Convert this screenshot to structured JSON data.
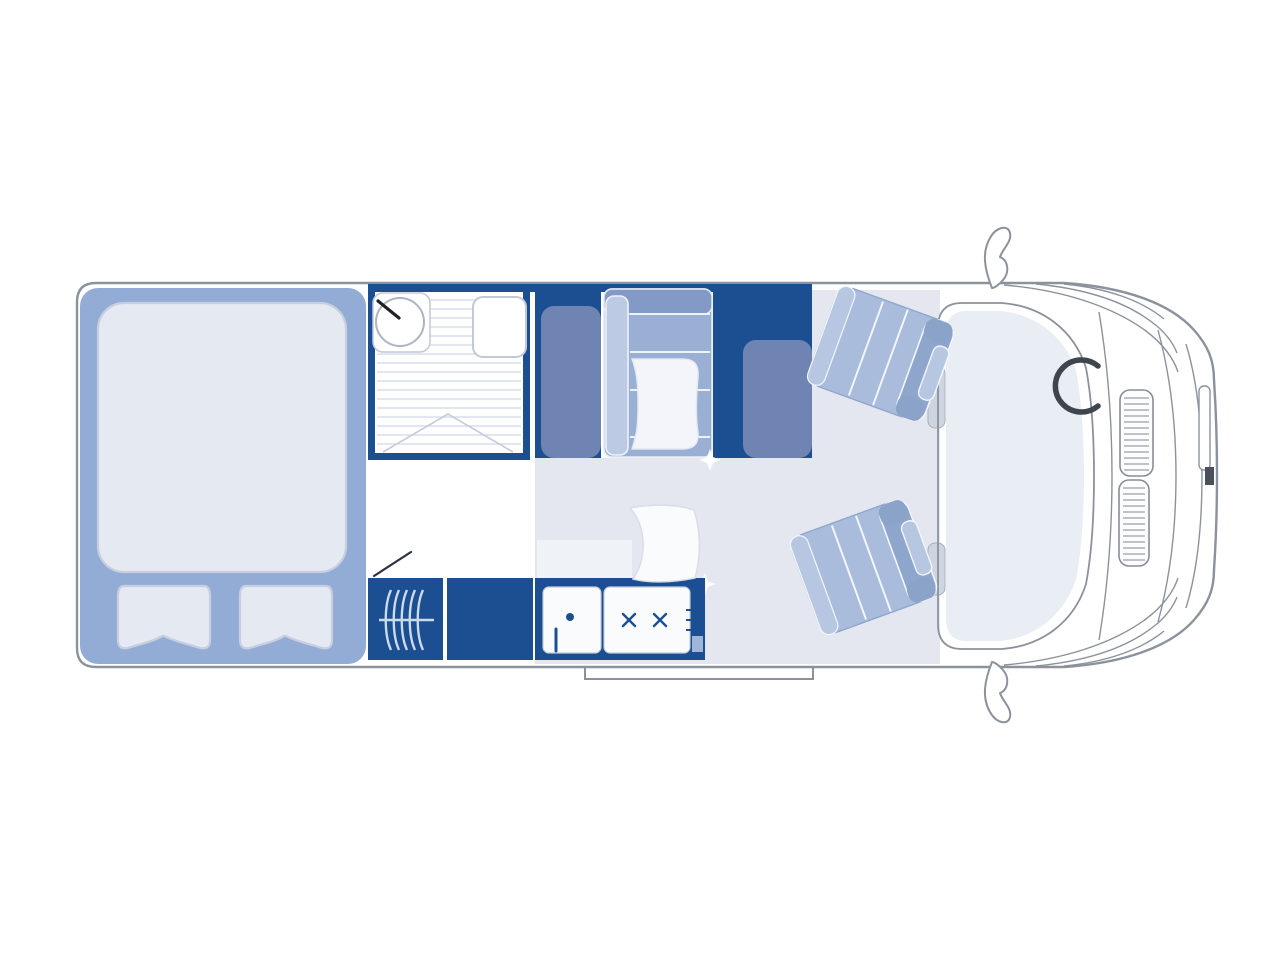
{
  "meta": {
    "title": "Motorhome floor plan, top view",
    "canvas": {
      "width": 1280,
      "height": 960
    }
  },
  "colors": {
    "navy": "#1B4F92",
    "bed": "#93ACD5",
    "slate": "#6F84B2",
    "bench": "#9AAFD4",
    "benchTop": "#8399C6",
    "benchLight": "#BCCAE4",
    "seat": "#A9BCDC",
    "seatBand": "#8FA6CC",
    "seatLight": "#B7C7E2",
    "seatFold": "#8BA2C9",
    "linen": "#E5E9F2",
    "linenEdge": "#C6CEDF",
    "floor": "#E4E7EF",
    "floorLight": "#EFF2F7",
    "stripe": "#D7DFEE",
    "outline": "#8C929C",
    "panelEdge": "#C5CBD8",
    "dark": "#3F454D",
    "cushion": "#F3F5FA",
    "hatch": "#9AA0AB",
    "dash": "#E9EDF4",
    "heaterLine": "#CBD9EC",
    "white": "#FFFFFF"
  },
  "floorplan": {
    "areas": [
      {
        "id": "vehicle-body",
        "label": "Motorhome body outline, top view"
      },
      {
        "id": "rear-bed",
        "label": "Rear double bed with duvet and two pillows"
      },
      {
        "id": "washroom",
        "label": "Washroom with shower tray, basin and toilet"
      },
      {
        "id": "wardrobe-rear",
        "label": "Wardrobe cabinet"
      },
      {
        "id": "dinette-bench",
        "label": "Forward-facing bench seat with cushion"
      },
      {
        "id": "wardrobe-front",
        "label": "Cabinet with seat backrest"
      },
      {
        "id": "swivel-seat-upper",
        "label": "Swivelled cab seat, upper"
      },
      {
        "id": "swivel-seat-lower",
        "label": "Swivelled cab seat, lower"
      },
      {
        "id": "kitchen-heater",
        "label": "Heater unit"
      },
      {
        "id": "kitchen-counter",
        "label": "Kitchen counter block"
      },
      {
        "id": "kitchen-sink",
        "label": "Kitchen sink with tap"
      },
      {
        "id": "kitchen-hob",
        "label": "Two burner gas hob"
      },
      {
        "id": "table",
        "label": "Removable table"
      },
      {
        "id": "entry-door",
        "label": "Entry door swing line"
      },
      {
        "id": "entry-step",
        "label": "Entry step"
      },
      {
        "id": "cab",
        "label": "Driver cab with dashboard and windscreen"
      },
      {
        "id": "steering-wheel",
        "label": "Steering wheel"
      },
      {
        "id": "mirror-top",
        "label": "Side mirror, upper"
      },
      {
        "id": "mirror-bottom",
        "label": "Side mirror, lower"
      },
      {
        "id": "front-grille",
        "label": "Front grille vents and bumper"
      }
    ]
  }
}
